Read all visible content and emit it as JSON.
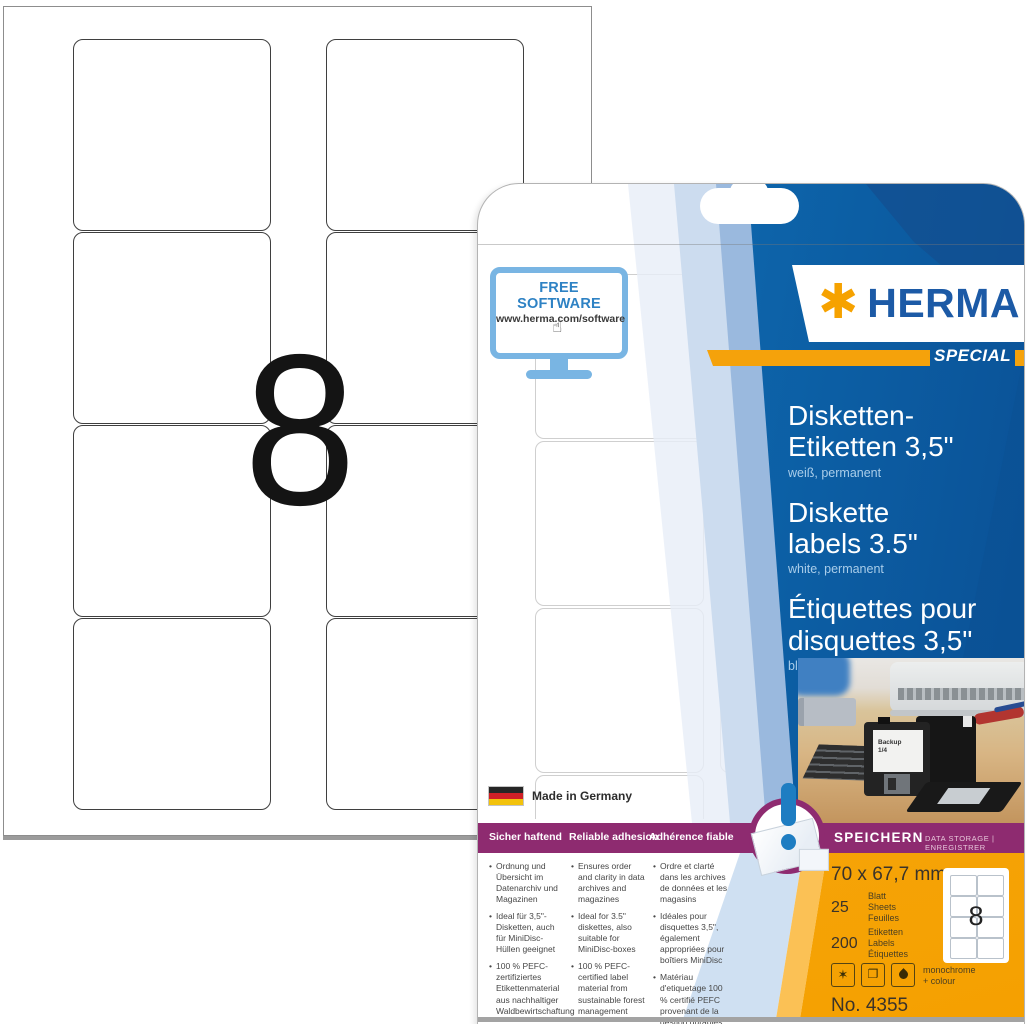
{
  "sheet": {
    "big_count": "8"
  },
  "package": {
    "free_software": {
      "title": "FREE SOFTWARE",
      "url": "www.herma.com/software"
    },
    "brand": {
      "asterisk": "✱",
      "wordmark": "HERMA",
      "special": "SPECIAL"
    },
    "products": [
      {
        "line1": "Disketten-",
        "line2": "Etiketten 3,5\"",
        "subtitle": "weiß, permanent"
      },
      {
        "line1": "Diskette",
        "line2": "labels 3.5\"",
        "subtitle": "white, permanent"
      },
      {
        "line1": "Étiquettes pour",
        "line2": "disquettes 3,5\"",
        "subtitle": "blanches, permanentes"
      }
    ],
    "photo": {
      "disk_label_line1": "Backup",
      "disk_label_line2": "1/4"
    },
    "made_in": "Made in Germany",
    "features": [
      {
        "header": "Sicher haftend",
        "bullets": [
          "Ordnung und Übersicht im Datenarchiv und Magazinen",
          "Ideal für 3,5\"-Disketten, auch für MiniDisc-Hüllen geeignet",
          "100 % PEFC-zertifiziertes Etikettenmaterial aus nachhaltiger Waldbewirtschaftung"
        ]
      },
      {
        "header": "Reliable adhesion",
        "bullets": [
          "Ensures order and clarity in data archives and magazines",
          "Ideal for 3.5\" diskettes, also suitable for MiniDisc-boxes",
          "100 % PEFC-certified label material from sustainable forest management"
        ]
      },
      {
        "header": "Adhérence fiable",
        "bullets": [
          "Ordre et clarté dans les archives de données et les magasins",
          "Idéales pour disquettes 3,5\", également appropriées pour boîtiers MiniDisc",
          "Matériau d'etiquetage 100 % certifié PEFC provenant de la gestion durables des forêts"
        ]
      }
    ],
    "storage_band": {
      "primary": "SPEICHERN",
      "secondary": "DATA STORAGE | ENREGISTRER"
    },
    "specs": {
      "size": "70 x 67,7 mm",
      "sheets_value": "25",
      "sheets_units": [
        "Blatt",
        "Sheets",
        "Feuilles"
      ],
      "labels_value": "200",
      "labels_units": [
        "Etiketten",
        "Labels",
        "Étiquettes"
      ],
      "printing_line1": "monochrome",
      "printing_line2": "+ colour",
      "item_no": "No. 4355",
      "mini_sheet_count": "8"
    },
    "colors": {
      "brand_blue": "#1c5aa6",
      "panel_blue": "#0d63a9",
      "accent_orange": "#f5a20b",
      "purple": "#8e2b70"
    }
  }
}
